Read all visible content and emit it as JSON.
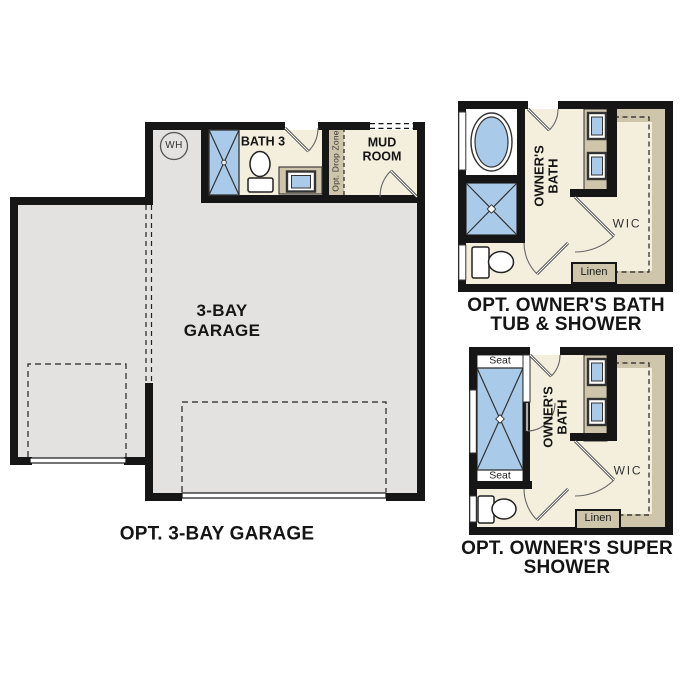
{
  "title": "Optional floor plan details",
  "colors": {
    "wall": "#161616",
    "garage_floor": "#e3e2e0",
    "room_floor": "#f4eedd",
    "fixture_tan": "#cec5ab",
    "water_blue": "#a9cae9",
    "door_line": "#666666",
    "white": "#ffffff"
  },
  "garage_plan": {
    "wh": "WH",
    "bath3": "BATH 3",
    "drop_zone": "Opt. Drop Zone",
    "mud_room_line1": "MUD",
    "mud_room_line2": "ROOM",
    "room_line1": "3-BAY",
    "room_line2": "GARAGE",
    "caption": "OPT. 3-BAY GARAGE"
  },
  "tub_shower_plan": {
    "owners_bath_line1": "OWNER'S",
    "owners_bath_line2": "BATH",
    "wic": "WIC",
    "linen": "Linen",
    "caption_line1": "OPT. OWNER'S BATH",
    "caption_line2": "TUB & SHOWER"
  },
  "super_shower_plan": {
    "owners_bath_line1": "OWNER'S",
    "owners_bath_line2": "BATH",
    "wic": "WIC",
    "linen": "Linen",
    "seat_top": "Seat",
    "seat_bottom": "Seat",
    "caption_line1": "OPT. OWNER'S SUPER",
    "caption_line2": "SHOWER"
  }
}
